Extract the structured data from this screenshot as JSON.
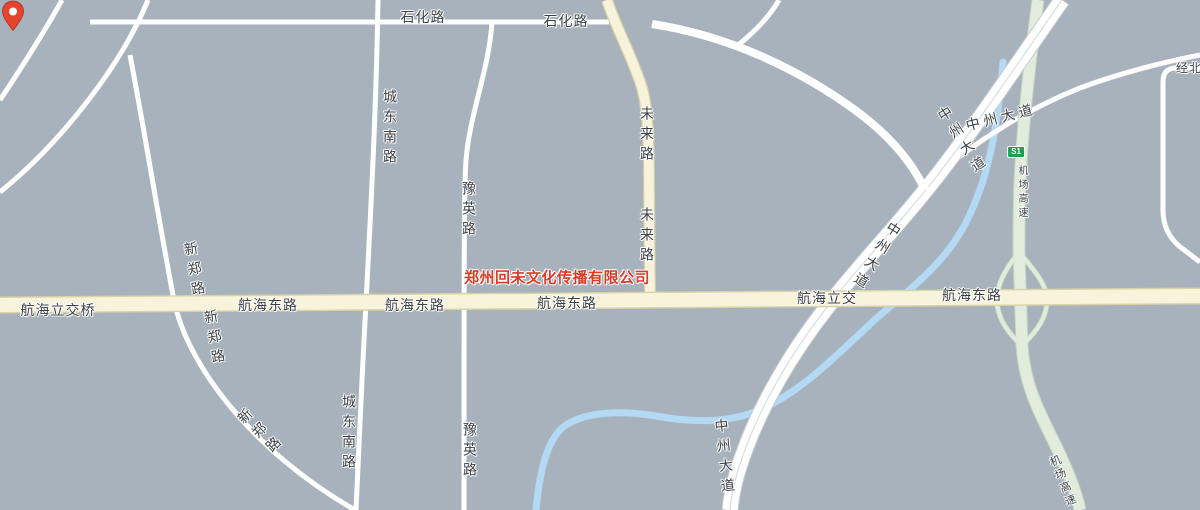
{
  "map": {
    "background_color": "#a8b2bc",
    "water_color": "#b3d9f4",
    "road_fill_minor": "#ffffff",
    "road_fill_arterial": "#f8f4db",
    "road_fill_expressway": "#e1ecdd",
    "marker": {
      "label": "郑州回未文化传播有限公司",
      "pin_color": "#e8432d",
      "label_color": "#df3a26"
    },
    "expressway_shield": {
      "text": "S1",
      "fill": "#1e9e4e"
    },
    "road_labels": {
      "shihua_1": "石化路",
      "shihua_2": "石化路",
      "chengdongnan_top": "城东南路",
      "chengdongnan_bottom": "城东南路",
      "yuying_top": "豫英路",
      "yuying_bottom": "豫英路",
      "weilai_top": "未来路",
      "weilai_bottom": "未来路",
      "xinzheng_upper": "新郑路",
      "xinzheng_lower": "新郑路",
      "xinzheng_bottom": "新郑路",
      "hanghai_lijiaoqiao": "航海立交桥",
      "hanghai_dong_1": "航海东路",
      "hanghai_dong_2": "航海东路",
      "hanghai_dong_3": "航海东路",
      "hanghai_lijiao": "航海立交",
      "hanghai_dong_4": "航海东路",
      "zhongzhou_top_a": "中州大道",
      "zhongzhou_top_b": "中州大道",
      "zhongzhou_mid": "中州大道",
      "zhongzhou_bottom": "中州大道",
      "jichang_gaosu_vertical": "机场高速",
      "jichang_gaosu_bottom": "机场高速",
      "jingbei_partial": "经北"
    }
  }
}
